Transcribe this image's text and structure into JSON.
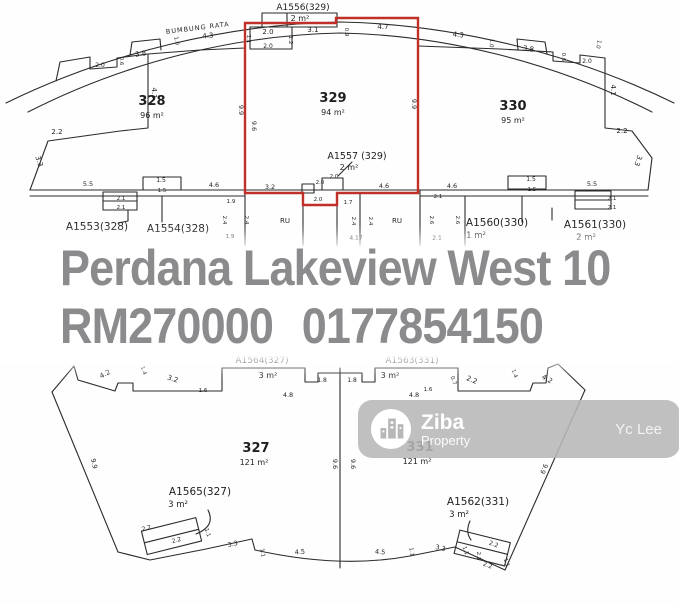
{
  "overlay": {
    "title": "Perdana Lakeview West 10",
    "price": "RM270000",
    "phone": "0177854150",
    "text_color": "#8b8b8e"
  },
  "watermark": {
    "brand": "Ziba",
    "brand_sub": "Property",
    "agent": "Yc Lee",
    "bg_color": "#b7b7b7"
  },
  "colors": {
    "highlight_lot_outline": "#c03028",
    "plan_line": "#2b2b2b"
  },
  "plan_top": {
    "labels": [
      {
        "t": "A1556(329)",
        "x": 303,
        "y": 10,
        "s": 9,
        "n": "accessory-label"
      },
      {
        "t": "2 m²",
        "x": 300,
        "y": 21,
        "s": 8,
        "n": "accessory-area"
      },
      {
        "t": "BUMBUNG RATA",
        "x": 198,
        "y": 30,
        "s": 6.5,
        "r": -7,
        "ls": 1,
        "n": "roof-label"
      },
      {
        "t": "4.3",
        "x": 208,
        "y": 38,
        "r": -5
      },
      {
        "t": "1.1",
        "x": 247,
        "y": 39,
        "r": 90,
        "s": 5.5
      },
      {
        "t": "2.0",
        "x": 268,
        "y": 34
      },
      {
        "t": "1.2",
        "x": 289,
        "y": 40,
        "r": 90,
        "s": 5.5
      },
      {
        "t": "3.1",
        "x": 313,
        "y": 32
      },
      {
        "t": "0.9",
        "x": 345,
        "y": 32,
        "r": 90,
        "s": 5.5
      },
      {
        "t": "4.7",
        "x": 383,
        "y": 29
      },
      {
        "t": "4.3",
        "x": 458,
        "y": 37,
        "r": 6
      },
      {
        "t": "1.0",
        "x": 490,
        "y": 43,
        "r": 95,
        "s": 5.5
      },
      {
        "t": "3.8",
        "x": 528,
        "y": 51,
        "r": 9
      },
      {
        "t": "2.0",
        "x": 268,
        "y": 48,
        "s": 6
      },
      {
        "t": "1.0",
        "x": 175,
        "y": 41,
        "r": 80,
        "s": 5.5
      },
      {
        "t": "3.8",
        "x": 141,
        "y": 56,
        "r": -9
      },
      {
        "t": "0.6",
        "x": 120,
        "y": 61,
        "r": 90,
        "s": 5.5
      },
      {
        "t": "2.0",
        "x": 100,
        "y": 67,
        "s": 6
      },
      {
        "t": "4.1",
        "x": 152,
        "y": 93,
        "r": 90
      },
      {
        "t": "2.2",
        "x": 57,
        "y": 134
      },
      {
        "t": "3.3",
        "x": 37,
        "y": 162,
        "r": 72
      },
      {
        "t": "1.0",
        "x": 597,
        "y": 44,
        "r": 100,
        "s": 5.5
      },
      {
        "t": "2.0",
        "x": 587,
        "y": 63,
        "s": 6
      },
      {
        "t": "0.6",
        "x": 562,
        "y": 57,
        "r": 90,
        "s": 5.5
      },
      {
        "t": "4.1",
        "x": 611,
        "y": 90,
        "r": 90
      },
      {
        "t": "2.2",
        "x": 622,
        "y": 133
      },
      {
        "t": "3.3",
        "x": 636,
        "y": 160,
        "r": 108
      },
      {
        "t": "328",
        "x": 152,
        "y": 105,
        "s": 13,
        "b": 1,
        "n": "lot-number"
      },
      {
        "t": "96 m²",
        "x": 152,
        "y": 118,
        "s": 8,
        "n": "lot-area"
      },
      {
        "t": "329",
        "x": 333,
        "y": 102,
        "s": 13,
        "b": 1,
        "n": "lot-number"
      },
      {
        "t": "94 m²",
        "x": 333,
        "y": 115,
        "s": 8,
        "n": "lot-area"
      },
      {
        "t": "330",
        "x": 513,
        "y": 110,
        "s": 13,
        "b": 1,
        "n": "lot-number"
      },
      {
        "t": "95 m²",
        "x": 513,
        "y": 123,
        "s": 8,
        "n": "lot-area"
      },
      {
        "t": "9.9",
        "x": 239,
        "y": 110,
        "r": 90,
        "s": 6.5
      },
      {
        "t": "9.6",
        "x": 252,
        "y": 126,
        "r": 90,
        "s": 6.5
      },
      {
        "t": "9.9",
        "x": 412,
        "y": 104,
        "r": 90,
        "s": 6.5
      },
      {
        "t": "A1557 (329)",
        "x": 357,
        "y": 159,
        "s": 9.5,
        "n": "accessory-label"
      },
      {
        "t": "2 m²",
        "x": 349,
        "y": 170,
        "s": 8,
        "n": "accessory-area"
      },
      {
        "t": "2.0",
        "x": 334,
        "y": 178,
        "s": 5.5
      },
      {
        "t": "5.5",
        "x": 88,
        "y": 186,
        "s": 6.5
      },
      {
        "t": "2.1",
        "x": 121,
        "y": 200,
        "s": 5.5
      },
      {
        "t": "2.1",
        "x": 121,
        "y": 209,
        "s": 5.5
      },
      {
        "t": "1.5",
        "x": 161,
        "y": 182,
        "s": 6
      },
      {
        "t": "1.5",
        "x": 162,
        "y": 192,
        "s": 5.5
      },
      {
        "t": "4.6",
        "x": 214,
        "y": 187,
        "s": 6.5
      },
      {
        "t": "1.9",
        "x": 231,
        "y": 203,
        "s": 5.5
      },
      {
        "t": "2.4",
        "x": 223,
        "y": 220,
        "r": 90,
        "s": 5.5
      },
      {
        "t": "2.4",
        "x": 245,
        "y": 220,
        "r": 90,
        "s": 5.5
      },
      {
        "t": "1.9",
        "x": 230,
        "y": 238,
        "s": 5.5
      },
      {
        "t": "A1553(328)",
        "x": 97,
        "y": 230,
        "s": 10.5,
        "n": "accessory-label"
      },
      {
        "t": "A1554(328)",
        "x": 178,
        "y": 232,
        "s": 10.5,
        "n": "accessory-label"
      },
      {
        "t": "3.2",
        "x": 270,
        "y": 189,
        "s": 6.5
      },
      {
        "t": "2.0",
        "x": 320,
        "y": 184,
        "s": 5.5
      },
      {
        "t": "2.0",
        "x": 318,
        "y": 201,
        "s": 5.5
      },
      {
        "t": "RU",
        "x": 285,
        "y": 223,
        "s": 7,
        "n": "room-label"
      },
      {
        "t": "1.7",
        "x": 348,
        "y": 204,
        "s": 5.5
      },
      {
        "t": "2.4",
        "x": 352,
        "y": 221,
        "r": 90,
        "s": 5.5
      },
      {
        "t": "2.4",
        "x": 369,
        "y": 221,
        "r": 90,
        "s": 5.5
      },
      {
        "t": "4.17",
        "x": 356,
        "y": 240,
        "s": 6
      },
      {
        "t": "RU",
        "x": 397,
        "y": 223,
        "s": 7,
        "n": "room-label"
      },
      {
        "t": "4.6",
        "x": 384,
        "y": 188,
        "s": 6.5
      },
      {
        "t": "4.6",
        "x": 452,
        "y": 188,
        "s": 6.5
      },
      {
        "t": "2.1",
        "x": 438,
        "y": 198,
        "s": 5.5
      },
      {
        "t": "2.6",
        "x": 430,
        "y": 220,
        "r": 90,
        "s": 5.5
      },
      {
        "t": "2.6",
        "x": 456,
        "y": 220,
        "r": 90,
        "s": 5.5
      },
      {
        "t": "2.1",
        "x": 437,
        "y": 240,
        "s": 6
      },
      {
        "t": "1.5",
        "x": 531,
        "y": 181,
        "s": 6
      },
      {
        "t": "1.5",
        "x": 532,
        "y": 191,
        "s": 5.5
      },
      {
        "t": "5.5",
        "x": 592,
        "y": 186,
        "s": 6.5
      },
      {
        "t": "2.1",
        "x": 612,
        "y": 200,
        "s": 5.5
      },
      {
        "t": "2.1",
        "x": 612,
        "y": 209,
        "s": 5.5
      },
      {
        "t": "A1560(330)",
        "x": 497,
        "y": 226,
        "s": 10.5,
        "n": "accessory-label"
      },
      {
        "t": "1 m²",
        "x": 476,
        "y": 238,
        "s": 8.5,
        "n": "accessory-area"
      },
      {
        "t": "A1561(330)",
        "x": 595,
        "y": 228,
        "s": 10.5,
        "n": "accessory-label"
      },
      {
        "t": "2 m²",
        "x": 586,
        "y": 240,
        "s": 8.5,
        "n": "accessory-area"
      }
    ]
  },
  "plan_bottom": {
    "labels": [
      {
        "t": "4.2",
        "x": 106,
        "y": 376,
        "r": -28
      },
      {
        "t": "1.4",
        "x": 142,
        "y": 371,
        "r": 70,
        "s": 5.5
      },
      {
        "t": "3.2",
        "x": 172,
        "y": 381,
        "r": 18
      },
      {
        "t": "1.6",
        "x": 203,
        "y": 392,
        "s": 5.5
      },
      {
        "t": "A1564(327)",
        "x": 262,
        "y": 363,
        "s": 9,
        "n": "accessory-label"
      },
      {
        "t": "3 m²",
        "x": 268,
        "y": 378,
        "s": 8,
        "n": "accessory-area"
      },
      {
        "t": "1.8",
        "x": 322,
        "y": 382,
        "s": 6
      },
      {
        "t": "1.8",
        "x": 352,
        "y": 382,
        "s": 6
      },
      {
        "t": "A1563(331)",
        "x": 412,
        "y": 363,
        "s": 9,
        "n": "accessory-label"
      },
      {
        "t": "3 m²",
        "x": 390,
        "y": 378,
        "s": 8,
        "n": "accessory-area"
      },
      {
        "t": "4.8",
        "x": 288,
        "y": 397,
        "s": 6.5
      },
      {
        "t": "4.8",
        "x": 414,
        "y": 397,
        "s": 6.5
      },
      {
        "t": "1.6",
        "x": 428,
        "y": 391,
        "s": 5.5
      },
      {
        "t": "0.7",
        "x": 452,
        "y": 381,
        "r": 70,
        "s": 5.5
      },
      {
        "t": "2.2",
        "x": 471,
        "y": 382,
        "r": 22
      },
      {
        "t": "1.4",
        "x": 513,
        "y": 374,
        "r": 70,
        "s": 5.5
      },
      {
        "t": "4.2",
        "x": 546,
        "y": 381,
        "r": 30
      },
      {
        "t": "9.9",
        "x": 92,
        "y": 464,
        "r": 78,
        "s": 6.5
      },
      {
        "t": "9.9",
        "x": 542,
        "y": 468,
        "r": 112,
        "s": 6.5
      },
      {
        "t": "9.6",
        "x": 333,
        "y": 464,
        "r": 90,
        "s": 6.5
      },
      {
        "t": "9.6",
        "x": 351,
        "y": 464,
        "r": 90,
        "s": 6.5
      },
      {
        "t": "327",
        "x": 256,
        "y": 452,
        "s": 13,
        "b": 1,
        "n": "lot-number"
      },
      {
        "t": "121 m²",
        "x": 254,
        "y": 465,
        "s": 8,
        "n": "lot-area"
      },
      {
        "t": "331",
        "x": 420,
        "y": 451,
        "s": 13,
        "b": 1,
        "n": "lot-number"
      },
      {
        "t": "121 m²",
        "x": 417,
        "y": 464,
        "s": 8,
        "n": "lot-area"
      },
      {
        "t": "A1565(327)",
        "x": 200,
        "y": 495,
        "s": 10.5,
        "n": "accessory-label"
      },
      {
        "t": "3 m²",
        "x": 178,
        "y": 507,
        "s": 8.5,
        "n": "accessory-area"
      },
      {
        "t": "2.2",
        "x": 147,
        "y": 530,
        "r": -15,
        "s": 6
      },
      {
        "t": "2.2",
        "x": 177,
        "y": 542,
        "r": -15,
        "s": 6
      },
      {
        "t": "1.1",
        "x": 206,
        "y": 533,
        "r": 72,
        "s": 5.5
      },
      {
        "t": "3.3",
        "x": 233,
        "y": 546,
        "r": -12,
        "s": 6.5
      },
      {
        "t": "1.1",
        "x": 261,
        "y": 553,
        "r": 80,
        "s": 5.5
      },
      {
        "t": "4.5",
        "x": 300,
        "y": 554,
        "r": -4,
        "s": 6.5
      },
      {
        "t": "4.5",
        "x": 380,
        "y": 554,
        "r": 4,
        "s": 6.5
      },
      {
        "t": "A1562(331)",
        "x": 478,
        "y": 505,
        "s": 10.5,
        "n": "accessory-label"
      },
      {
        "t": "3 m²",
        "x": 459,
        "y": 517,
        "s": 8.5,
        "n": "accessory-area"
      },
      {
        "t": "3.3",
        "x": 440,
        "y": 550,
        "r": 12,
        "s": 6.5
      },
      {
        "t": "1.1",
        "x": 410,
        "y": 552,
        "r": 82,
        "s": 5.5
      },
      {
        "t": "1.1",
        "x": 464,
        "y": 551,
        "r": 70,
        "s": 5.5
      },
      {
        "t": "2.1",
        "x": 477,
        "y": 556,
        "r": 90,
        "s": 5.5
      },
      {
        "t": "2.2",
        "x": 493,
        "y": 546,
        "r": 20,
        "s": 6
      },
      {
        "t": "2.2",
        "x": 487,
        "y": 567,
        "r": 20,
        "s": 6
      },
      {
        "t": "1.1",
        "x": 505,
        "y": 563,
        "r": 72,
        "s": 5.5
      }
    ]
  }
}
